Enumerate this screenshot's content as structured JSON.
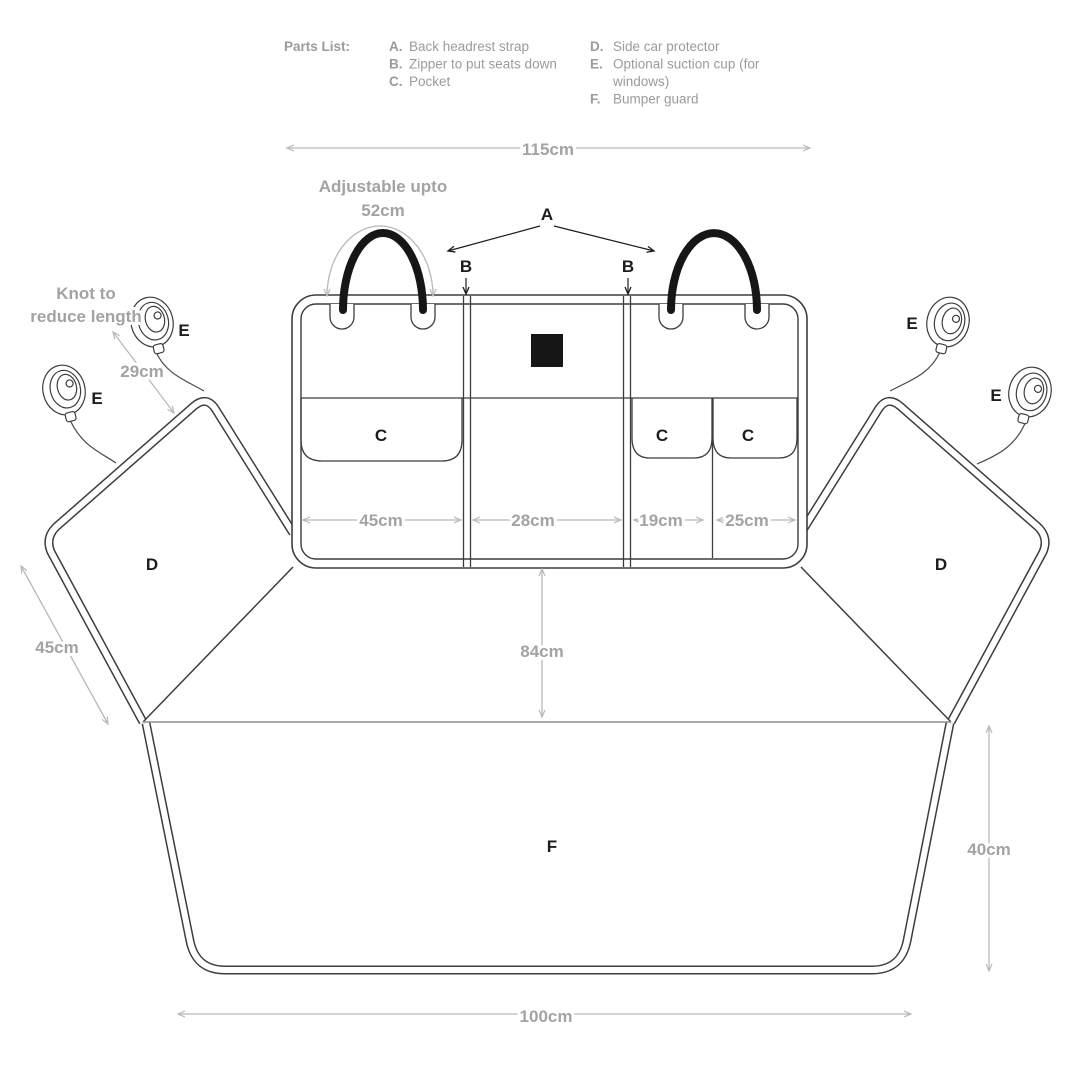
{
  "parts_list": {
    "title": "Parts List:",
    "a_letter": "A.",
    "a_text": "Back headrest strap",
    "b_letter": "B.",
    "b_text": "Zipper to put seats down",
    "c_letter": "C.",
    "c_text": "Pocket",
    "d_letter": "D.",
    "d_text": "Side car protector",
    "e_letter": "E.",
    "e_text": "Optional suction cup (for",
    "e_text2": "windows)",
    "f_letter": "F.",
    "f_text": "Bumper guard"
  },
  "annotations": {
    "adjustable_line1": "Adjustable upto",
    "adjustable_line2": "52cm",
    "knot_line1": "Knot to",
    "knot_line2": "reduce length"
  },
  "dimensions": {
    "overall_width": "115cm",
    "suction_strap": "29cm",
    "side_flap": "45cm",
    "pocket_large": "45cm",
    "middle_section": "28cm",
    "pocket_small_1": "19cm",
    "pocket_small_2": "25cm",
    "seat_depth": "84cm",
    "bumper_height": "40cm",
    "bottom_width": "100cm"
  },
  "part_labels": {
    "a": "A",
    "b": "B",
    "c": "C",
    "d": "D",
    "e": "E",
    "f": "F"
  },
  "colors": {
    "outline": "#3d3d3d",
    "dimension_lines": "#b9b9b9",
    "dimension_text": "#a3a3a3",
    "parts_list_text": "#9b9b9b",
    "label_text": "#1d1d1d",
    "strap": "#161616",
    "background": "#ffffff"
  }
}
